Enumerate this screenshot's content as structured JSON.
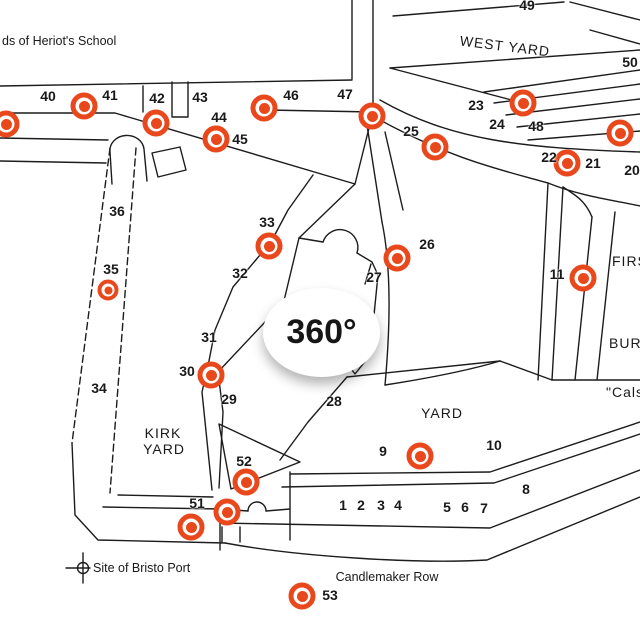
{
  "map": {
    "accent_color": "#E8481C",
    "panorama_badge": "360°",
    "notes": [
      {
        "text": "ds of Heriot's School",
        "x": 2,
        "y": 41,
        "anchor": "left"
      },
      {
        "text": "Site of Bristo Port",
        "x": 93,
        "y": 568,
        "anchor": "left"
      },
      {
        "text": "Candlemaker Row",
        "x": 387,
        "y": 577,
        "anchor": "center"
      }
    ],
    "areas": [
      {
        "text": "WEST YARD",
        "x": 505,
        "y": 46,
        "rot": true
      },
      {
        "text": "YARD",
        "x": 442,
        "y": 413
      },
      {
        "text": "KIRK",
        "x": 163,
        "y": 433
      },
      {
        "text": "YARD",
        "x": 164,
        "y": 449
      },
      {
        "text": "FIRS",
        "x": 612,
        "y": 261,
        "anchor": "left"
      },
      {
        "text": "BURIA",
        "x": 609,
        "y": 343,
        "anchor": "left"
      },
      {
        "text": "\"Calsay",
        "x": 606,
        "y": 392,
        "anchor": "left"
      }
    ],
    "plot_numbers": [
      {
        "text": "40",
        "x": 48,
        "y": 96
      },
      {
        "text": "41",
        "x": 110,
        "y": 95
      },
      {
        "text": "42",
        "x": 157,
        "y": 98
      },
      {
        "text": "43",
        "x": 200,
        "y": 97
      },
      {
        "text": "44",
        "x": 219,
        "y": 117
      },
      {
        "text": "45",
        "x": 240,
        "y": 139
      },
      {
        "text": "46",
        "x": 291,
        "y": 95
      },
      {
        "text": "47",
        "x": 345,
        "y": 94
      },
      {
        "text": "49",
        "x": 527,
        "y": 5
      },
      {
        "text": "50",
        "x": 630,
        "y": 62
      },
      {
        "text": "23",
        "x": 476,
        "y": 105
      },
      {
        "text": "24",
        "x": 497,
        "y": 124
      },
      {
        "text": "48",
        "x": 536,
        "y": 126
      },
      {
        "text": "25",
        "x": 411,
        "y": 131
      },
      {
        "text": "22",
        "x": 549,
        "y": 157
      },
      {
        "text": "21",
        "x": 593,
        "y": 163
      },
      {
        "text": "20",
        "x": 632,
        "y": 170
      },
      {
        "text": "26",
        "x": 427,
        "y": 244
      },
      {
        "text": "27",
        "x": 374,
        "y": 277
      },
      {
        "text": "11",
        "x": 557,
        "y": 274
      },
      {
        "text": "33",
        "x": 267,
        "y": 222
      },
      {
        "text": "32",
        "x": 240,
        "y": 273
      },
      {
        "text": "31",
        "x": 209,
        "y": 337
      },
      {
        "text": "30",
        "x": 187,
        "y": 371
      },
      {
        "text": "36",
        "x": 117,
        "y": 211
      },
      {
        "text": "35",
        "x": 111,
        "y": 269
      },
      {
        "text": "34",
        "x": 99,
        "y": 388
      },
      {
        "text": "29",
        "x": 229,
        "y": 399
      },
      {
        "text": "28",
        "x": 334,
        "y": 401
      },
      {
        "text": "52",
        "x": 244,
        "y": 461
      },
      {
        "text": "51",
        "x": 197,
        "y": 503
      },
      {
        "text": "9",
        "x": 383,
        "y": 451
      },
      {
        "text": "10",
        "x": 494,
        "y": 445
      },
      {
        "text": "8",
        "x": 526,
        "y": 489
      },
      {
        "text": "53",
        "x": 330,
        "y": 595
      },
      {
        "text": "1",
        "x": 343,
        "y": 505
      },
      {
        "text": "2",
        "x": 361,
        "y": 505
      },
      {
        "text": "3",
        "x": 381,
        "y": 505
      },
      {
        "text": "4",
        "x": 398,
        "y": 505
      },
      {
        "text": "5",
        "x": 447,
        "y": 507
      },
      {
        "text": "6",
        "x": 465,
        "y": 507
      },
      {
        "text": "7",
        "x": 484,
        "y": 508
      }
    ],
    "panorama_markers": [
      {
        "x": 6,
        "y": 124
      },
      {
        "x": 84,
        "y": 106
      },
      {
        "x": 156,
        "y": 123
      },
      {
        "x": 216,
        "y": 139
      },
      {
        "x": 264,
        "y": 108
      },
      {
        "x": 372,
        "y": 116
      },
      {
        "x": 435,
        "y": 147
      },
      {
        "x": 523,
        "y": 103
      },
      {
        "x": 620,
        "y": 133
      },
      {
        "x": 567,
        "y": 163
      },
      {
        "x": 583,
        "y": 278
      },
      {
        "x": 269,
        "y": 246
      },
      {
        "x": 397,
        "y": 258
      },
      {
        "x": 108,
        "y": 290,
        "small": true
      },
      {
        "x": 211,
        "y": 375
      },
      {
        "x": 420,
        "y": 456
      },
      {
        "x": 246,
        "y": 482
      },
      {
        "x": 227,
        "y": 512
      },
      {
        "x": 191,
        "y": 527
      },
      {
        "x": 302,
        "y": 596
      }
    ]
  }
}
